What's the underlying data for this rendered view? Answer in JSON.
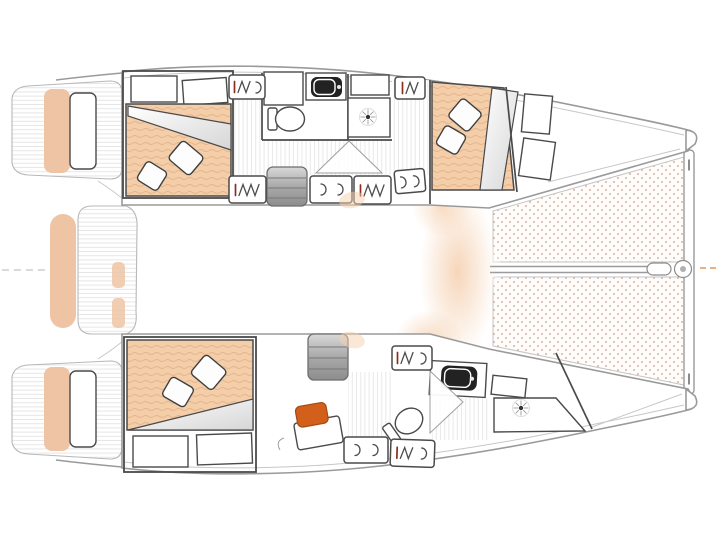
{
  "page": {
    "title": "Catamaran interior layout floor plan, top-down view, bow to the right",
    "background": "#ffffff"
  },
  "palette": {
    "outline": "#9a9a9a",
    "outline-soft": "#c7c7c7",
    "wall": "#4a4a4a",
    "mattress": "#f4cda9",
    "mattress-line": "#e4b58c",
    "cushion": "#eec4a5",
    "tramp-dot": "#d9ab95",
    "deck-line": "#e6e6e6",
    "accent-orange": "#d2601a",
    "dash-orange": "#e2955f",
    "sink": "#222222",
    "hatch-red": "#8a2f1f",
    "glow": "#f5cfae"
  },
  "diagram": {
    "type": "floor-plan",
    "subject": "sailing-catamaran",
    "view": "top-down-hull-level",
    "orientation": "bow-right",
    "hulls": [
      {
        "id": "starboard-hull",
        "position": "top",
        "rooms": [
          {
            "name": "aft-double-cabin",
            "furniture": [
              "double-berth",
              "two-pillows",
              "folded-duvet",
              "two-shelves"
            ]
          },
          {
            "name": "mid-head",
            "furniture": [
              "toilet",
              "washbasin",
              "shower-with-drain",
              "locker"
            ]
          },
          {
            "name": "forward-double-cabin",
            "furniture": [
              "double-berth",
              "two-pillows",
              "folded-duvet",
              "two-shelves"
            ]
          }
        ]
      },
      {
        "id": "port-hull",
        "position": "bottom",
        "rooms": [
          {
            "name": "aft-double-cabin",
            "furniture": [
              "double-berth",
              "two-pillows",
              "folded-duvet",
              "two-shelves"
            ]
          },
          {
            "name": "desk-area",
            "furniture": [
              "desk",
              "orange-stool-cushion"
            ]
          },
          {
            "name": "forward-head",
            "furniture": [
              "toilet",
              "washbasin",
              "shower-with-drain"
            ]
          }
        ]
      }
    ],
    "bow_features": [
      "starboard-trampoline-panel",
      "port-trampoline-panel",
      "bowsprit-with-fitting",
      "forward-crossbeam"
    ],
    "stern_features": [
      "starboard-swim-platform",
      "port-swim-platform",
      "aft-platform",
      "aft-bench-cushion"
    ],
    "counts": {
      "double_berths": 3,
      "heads": 2,
      "toilets": 2,
      "washbasins": 2,
      "showers": 2,
      "companionway_steps": 2,
      "trampoline_panels": 2,
      "swim_platforms": 2,
      "hatch_panels": 9
    }
  }
}
